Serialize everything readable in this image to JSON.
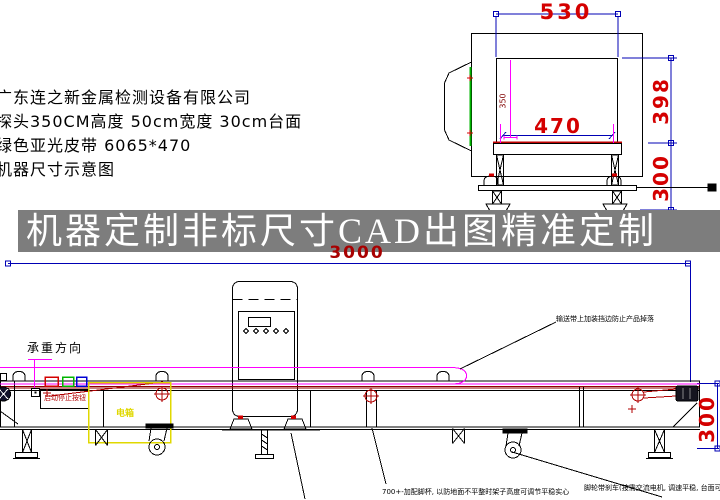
{
  "company_block": {
    "line1": "广东连之新金属检测设备有限公司",
    "line2": "探头350CM高度  50cm宽度  30cm台面",
    "line3": "绿色亚光皮带 6065*470",
    "line4": "机器尺寸示意图"
  },
  "banner": {
    "text": "机器定制非标尺寸CAD出图精准定制"
  },
  "front_view": {
    "dim_top_width": "530",
    "dim_height_upper": "398",
    "dim_tunnel_width": "470",
    "dim_height_lower": "300",
    "dim_tunnel_height": "350"
  },
  "side_view": {
    "dim_total_length": "3000",
    "dim_belt_height": "300",
    "label_load_direction": "承重方向",
    "label_start_stop": "启动停止按钮",
    "label_electric_box": "电箱",
    "note_hood": "输送带上加装挡边防止产品掉落",
    "note_foot": "700+-加配脚杯, 以防地面不平整时架子高度可调节平稳实心",
    "note_caster": "脚轮带刹车(按需交流电机, 调速平稳, 台面可调高度)",
    "note_caster_num": "300"
  },
  "colors": {
    "dim_red": "#d40000",
    "dark_red": "#a80000",
    "dim_blue": "#0000b4",
    "magenta": "#ff00ff",
    "banner_bg": "#7d7d7d",
    "accent_yellow": "#e0d800",
    "accent_green": "#00b400"
  }
}
